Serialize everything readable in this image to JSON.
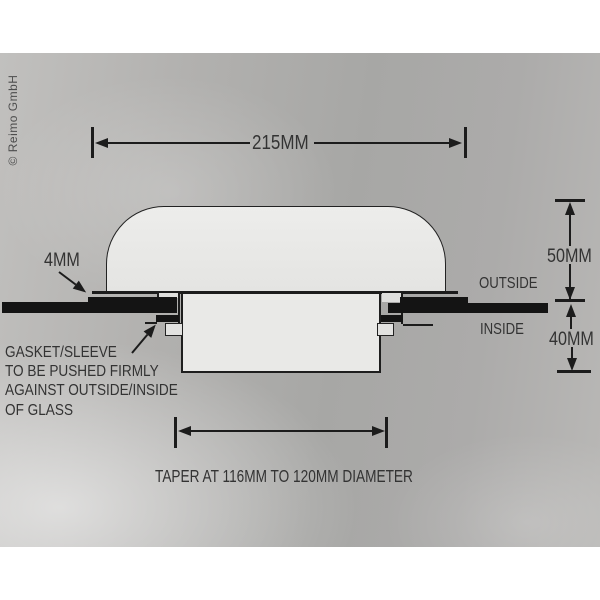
{
  "watermark": "© Reimo GmbH",
  "dims": {
    "overall_width": "215MM",
    "flange_lip": "4MM",
    "outside_height": "50MM",
    "inside_depth": "40MM"
  },
  "sides": {
    "outside": "OUTSIDE",
    "inside": "INSIDE"
  },
  "gasket_note": {
    "line1": "GASKET/SLEEVE",
    "line2": "TO BE PUSHED FIRMLY",
    "line3": "AGAINST OUTSIDE/INSIDE",
    "line4": "OF GLASS"
  },
  "taper_note": "TAPER AT 116MM TO 120MM DIAMETER",
  "colors": {
    "ink": "#1c1c1c",
    "glass": "#141414",
    "part_fill": "#e9e9e7",
    "photo_gray": "#adabaa",
    "page": "#ffffff",
    "text": "#333333"
  }
}
